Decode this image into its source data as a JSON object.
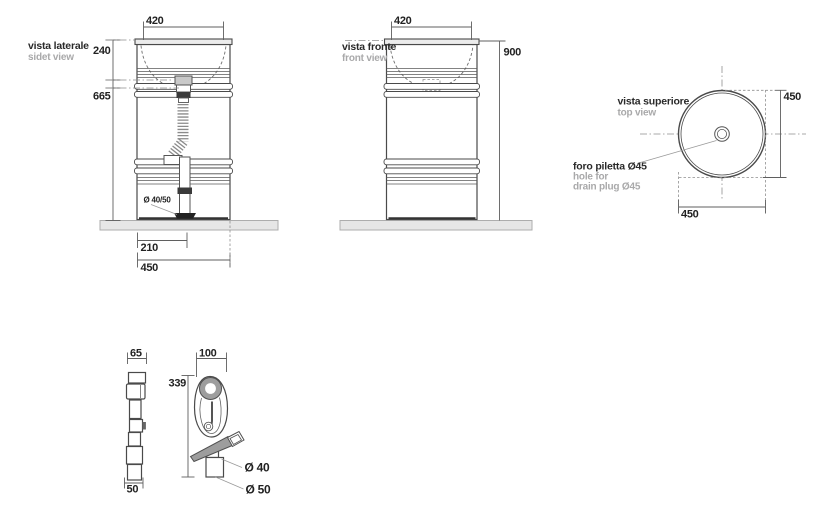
{
  "colors": {
    "line": "#4a4a4a",
    "dim_line": "#5f5f5f",
    "text_dark": "#222222",
    "text_gray": "#a9a9aa",
    "slab_fill": "#e6e6e6",
    "metal_gray": "#9d9d9d",
    "dark_fitting": "#3a3a3a"
  },
  "side_view": {
    "title": "vista laterale",
    "subtitle": "sidet view",
    "dim_top_width": "420",
    "dim_basin_depth": "240",
    "dim_lower_height": "665",
    "drain_label": "Ø 40/50",
    "dim_drain_offset": "210",
    "dim_base_width": "450"
  },
  "front_view": {
    "title": "vista fronte",
    "subtitle": "front view",
    "dim_top_width": "420",
    "dim_height": "900"
  },
  "top_view": {
    "title": "vista superiore",
    "subtitle": "top view",
    "dim_height": "450",
    "dim_width": "450",
    "note_line1": "foro piletta Ø45",
    "note_line2": "hole for",
    "note_line3": "drain plug Ø45"
  },
  "faucet": {
    "dim_side_width": "65",
    "dim_side_base": "50",
    "dim_front_width": "100",
    "dim_height": "339",
    "label_d40": "Ø 40",
    "label_d50": "Ø 50"
  }
}
